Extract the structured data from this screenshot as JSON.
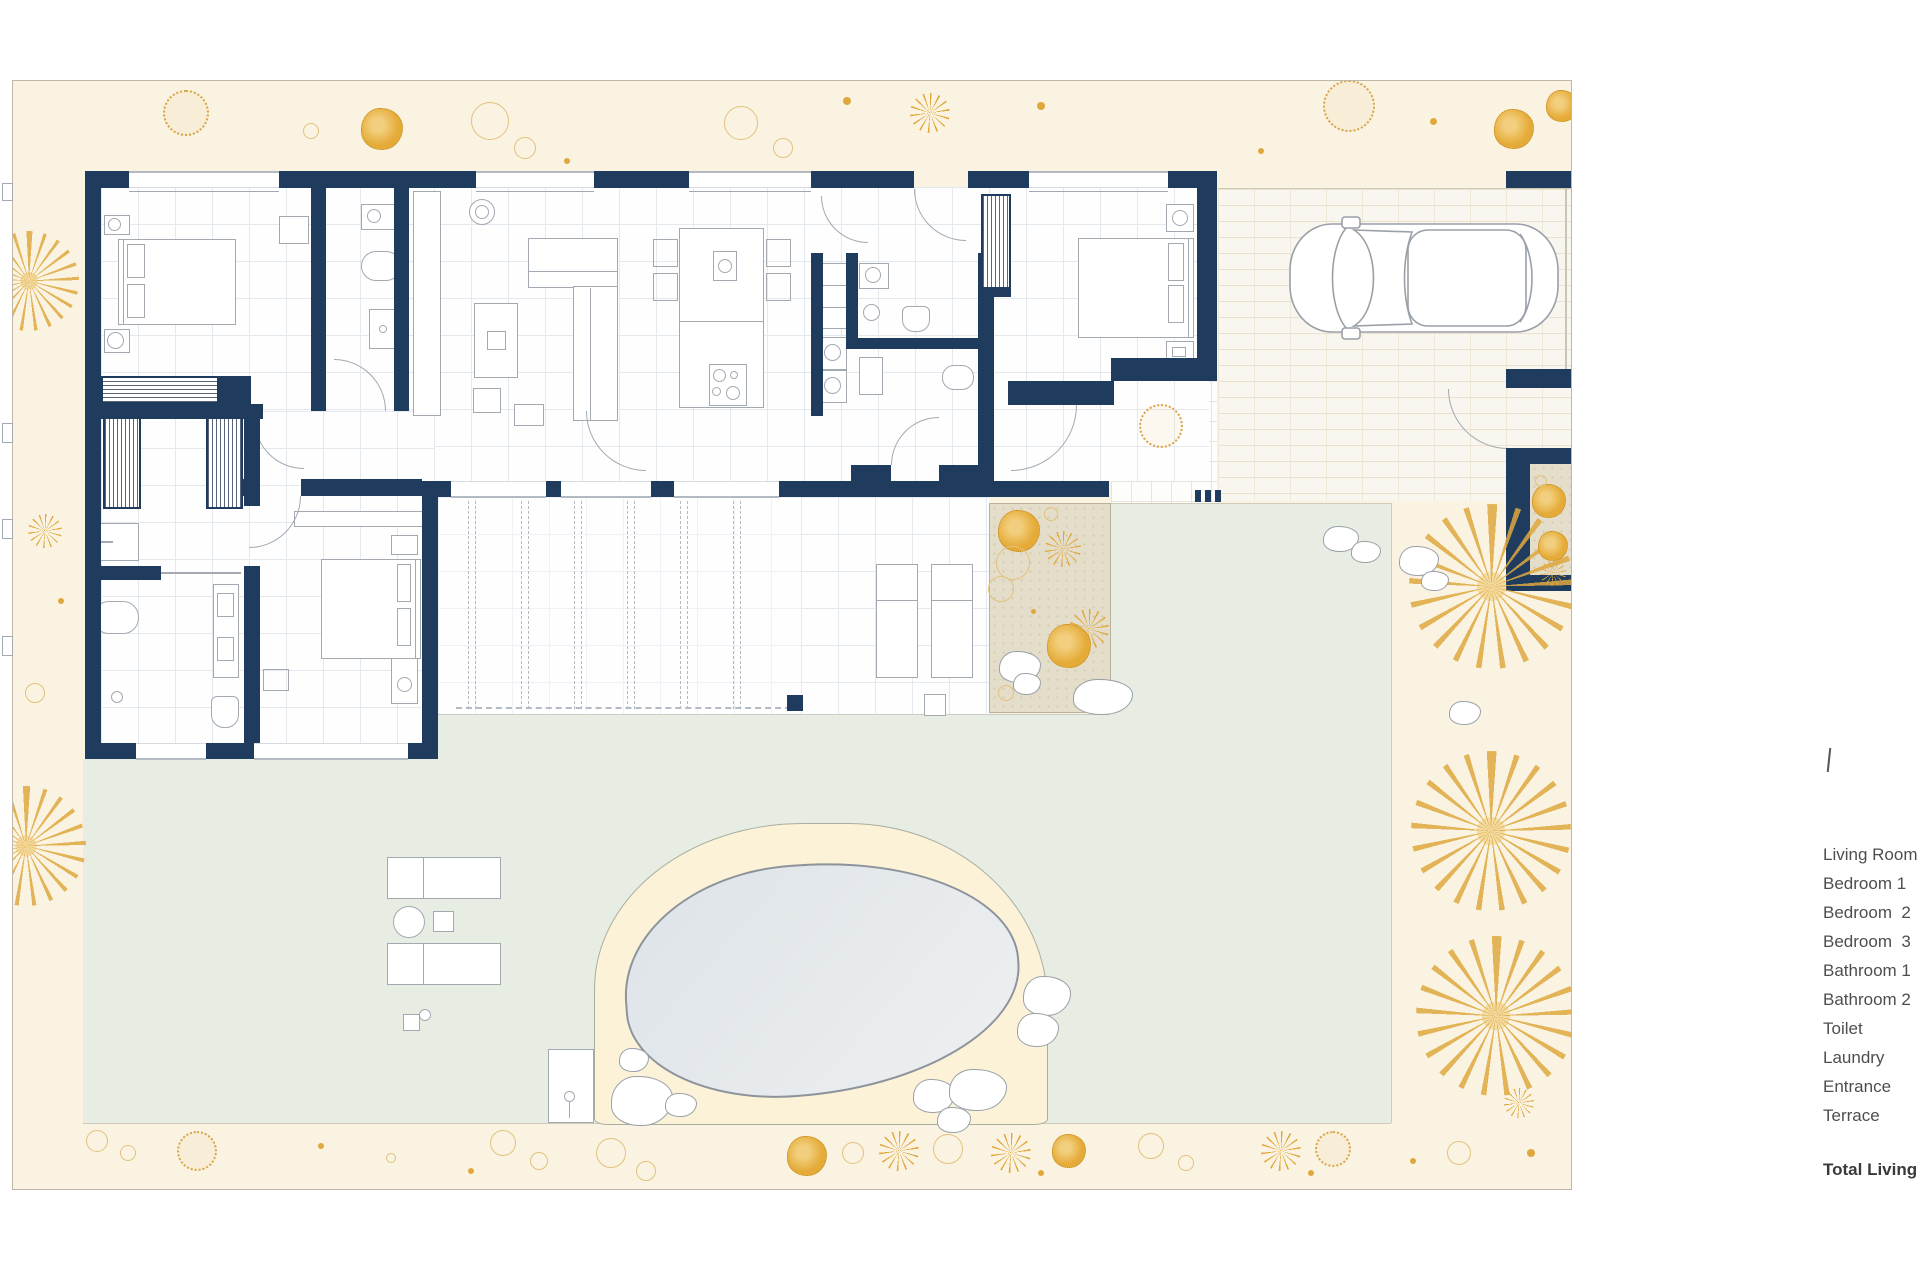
{
  "legend": {
    "items": [
      "Living Room",
      "Bedroom 1",
      "Bedroom  2",
      "Bedroom  3",
      "Bathroom 1",
      "Bathroom 2",
      "Toilet",
      "Laundry",
      "Entrance",
      "Terrace"
    ],
    "total_label": "Total Living"
  },
  "colors": {
    "wall_navy": "#1f3b5e",
    "garden_cream": "#faf3e2",
    "terrace_green": "#e8ede4",
    "accent_gold": "#e2a83c",
    "pool_water": "#dfe5ea",
    "pool_sand": "#fbf2d8",
    "tan_patch": "#e4ddc9"
  }
}
